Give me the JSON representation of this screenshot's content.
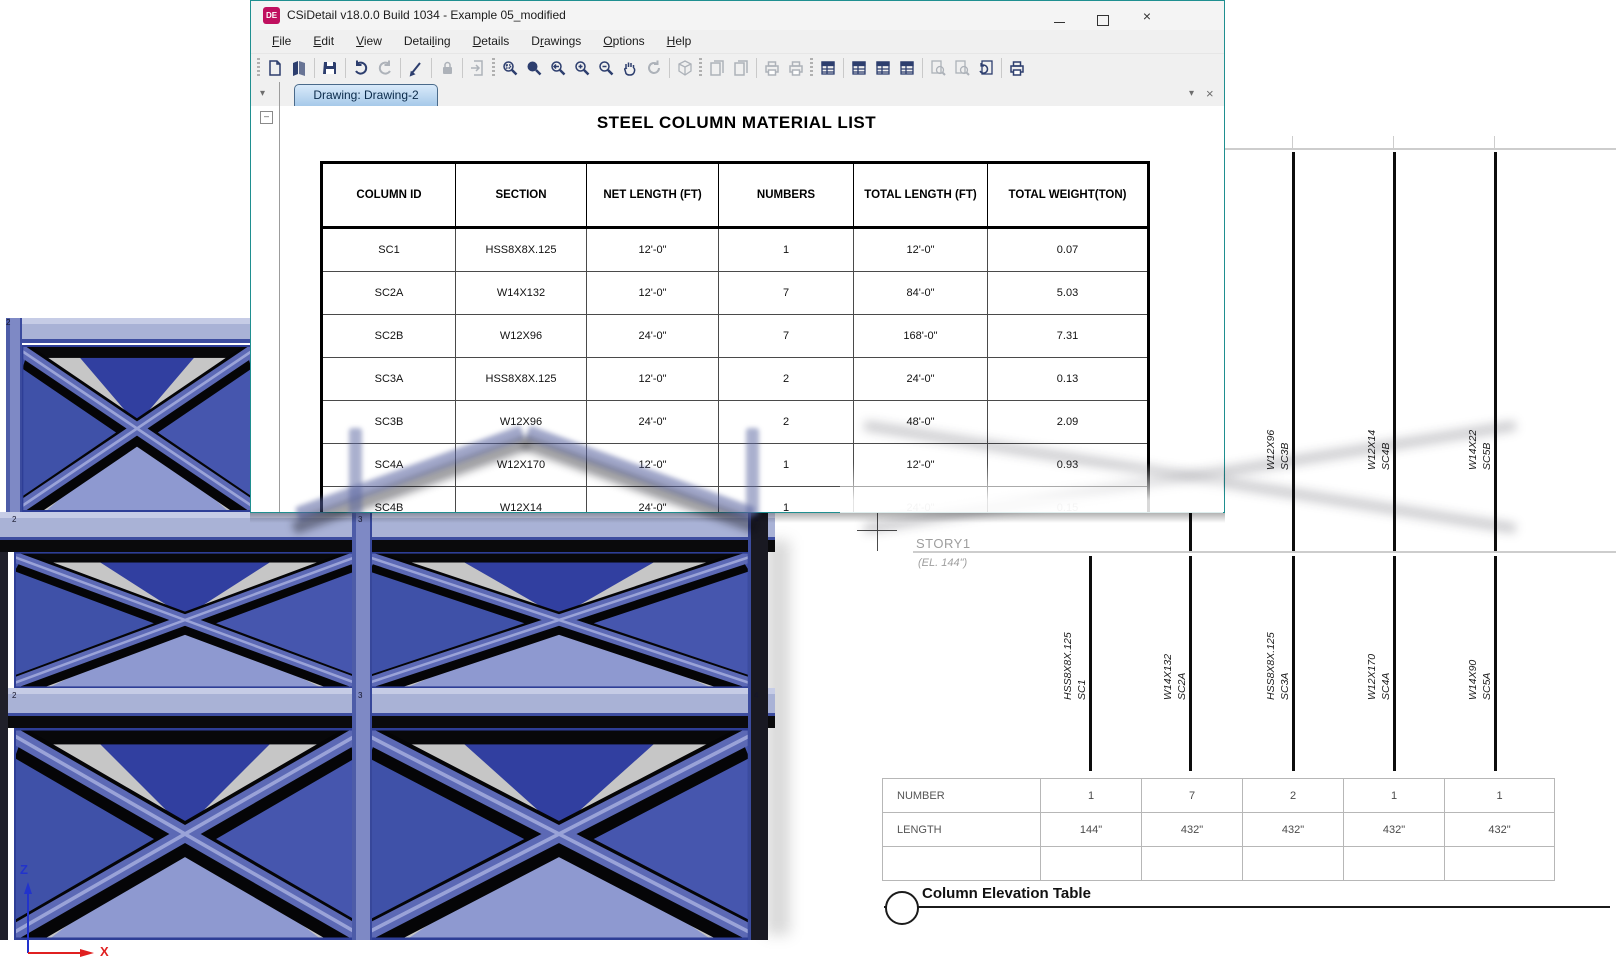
{
  "window": {
    "title": "CSiDetail v18.0.0 Build 1034 - Example 05_modified",
    "app_icon_text": "DE",
    "controls": {
      "close_glyph": "×"
    },
    "menu": {
      "items": [
        {
          "pre": "",
          "key": "F",
          "post": "ile"
        },
        {
          "pre": "",
          "key": "E",
          "post": "dit"
        },
        {
          "pre": "",
          "key": "V",
          "post": "iew"
        },
        {
          "pre": "Detai",
          "key": "l",
          "post": "ing"
        },
        {
          "pre": "",
          "key": "D",
          "post": "etails"
        },
        {
          "pre": "D",
          "key": "r",
          "post": "awings"
        },
        {
          "pre": "",
          "key": "O",
          "post": "ptions"
        },
        {
          "pre": "",
          "key": "H",
          "post": "elp"
        }
      ]
    },
    "toolbar": {
      "buttons": [
        {
          "type": "handle"
        },
        {
          "name": "new-document",
          "enabled": true
        },
        {
          "name": "open",
          "enabled": true
        },
        {
          "type": "sep"
        },
        {
          "name": "save",
          "enabled": true
        },
        {
          "type": "sep"
        },
        {
          "name": "undo",
          "enabled": true
        },
        {
          "name": "redo",
          "enabled": false
        },
        {
          "type": "sep"
        },
        {
          "name": "pen",
          "enabled": true
        },
        {
          "type": "sep"
        },
        {
          "name": "lock",
          "enabled": false
        },
        {
          "type": "sep"
        },
        {
          "name": "export-page",
          "enabled": false
        },
        {
          "type": "handle"
        },
        {
          "name": "zoom-window",
          "enabled": true
        },
        {
          "name": "zoom-in",
          "enabled": true
        },
        {
          "name": "zoom-previous",
          "enabled": true
        },
        {
          "name": "zoom-plus",
          "enabled": true
        },
        {
          "name": "zoom-minus",
          "enabled": true
        },
        {
          "name": "pan",
          "enabled": true
        },
        {
          "name": "rotate-view",
          "enabled": false
        },
        {
          "type": "sep"
        },
        {
          "name": "view-3d",
          "enabled": false
        },
        {
          "type": "handle"
        },
        {
          "name": "doc-previous",
          "enabled": false
        },
        {
          "name": "doc-next",
          "enabled": false
        },
        {
          "type": "sep"
        },
        {
          "name": "print-preview",
          "enabled": false
        },
        {
          "name": "print-export",
          "enabled": false
        },
        {
          "type": "handle"
        },
        {
          "name": "report-list",
          "enabled": true
        },
        {
          "type": "sep"
        },
        {
          "name": "report-options",
          "enabled": true
        },
        {
          "name": "report-table",
          "enabled": true
        },
        {
          "name": "report-window",
          "enabled": true
        },
        {
          "type": "sep"
        },
        {
          "name": "search-add",
          "enabled": false
        },
        {
          "name": "search-view",
          "enabled": false
        },
        {
          "name": "doc-refresh",
          "enabled": true
        },
        {
          "type": "sep"
        },
        {
          "name": "print",
          "enabled": true
        }
      ]
    },
    "tab_strip": {
      "active_tab": "Drawing: Drawing-2",
      "dropdown_glyph": "▾",
      "close_glyph": "×"
    }
  },
  "material_list": {
    "title": "STEEL COLUMN MATERIAL LIST",
    "columns": [
      "COLUMN ID",
      "SECTION",
      "NET LENGTH (FT)",
      "NUMBERS",
      "TOTAL LENGTH (FT)",
      "TOTAL WEIGHT(TON)"
    ],
    "rows": [
      [
        "SC1",
        "HSS8X8X.125",
        "12'-0\"",
        "1",
        "12'-0\"",
        "0.07"
      ],
      [
        "SC2A",
        "W14X132",
        "12'-0\"",
        "7",
        "84'-0\"",
        "5.03"
      ],
      [
        "SC2B",
        "W12X96",
        "24'-0\"",
        "7",
        "168'-0\"",
        "7.31"
      ],
      [
        "SC3A",
        "HSS8X8X.125",
        "12'-0\"",
        "2",
        "24'-0\"",
        "0.13"
      ],
      [
        "SC3B",
        "W12X96",
        "24'-0\"",
        "2",
        "48'-0\"",
        "2.09"
      ],
      [
        "SC4A",
        "W12X170",
        "12'-0\"",
        "1",
        "12'-0\"",
        "0.93"
      ],
      [
        "SC4B",
        "W12X14",
        "24'-0\"",
        "1",
        "24'-0\"",
        "0.15"
      ]
    ]
  },
  "elevation": {
    "story_label": "STORY1",
    "story_elevation": "(EL. 144\")",
    "upper_columns": [
      {
        "section": "W12X96",
        "id": "SC2B"
      },
      {
        "section": "W12X96",
        "id": "SC3B"
      },
      {
        "section": "W12X14",
        "id": "SC4B"
      },
      {
        "section": "W14X22",
        "id": "SC5B"
      }
    ],
    "lower_columns": [
      {
        "section": "HSS8X8X.125",
        "id": "SC1"
      },
      {
        "section": "W14X132",
        "id": "SC2A"
      },
      {
        "section": "HSS8X8X.125",
        "id": "SC3A"
      },
      {
        "section": "W12X170",
        "id": "SC4A"
      },
      {
        "section": "W14X90",
        "id": "SC5A"
      }
    ],
    "summary_table": {
      "rows": [
        {
          "label": "NUMBER",
          "values": [
            "1",
            "7",
            "2",
            "1",
            "1"
          ]
        },
        {
          "label": "LENGTH",
          "values": [
            "144\"",
            "432\"",
            "432\"",
            "432\"",
            "432\""
          ]
        }
      ]
    },
    "drawing_title": "Column Elevation Table"
  },
  "model": {
    "joint_labels": [
      "2",
      "3",
      "4"
    ],
    "axis": {
      "z": "Z",
      "x": "X"
    }
  },
  "colors": {
    "window_border_teal": "#1f8f90",
    "brand_magenta": "#c0105f",
    "tab_blue": "#a6c9e9",
    "member_blue": "#5c69b5",
    "member_light": "#9aa3d8",
    "panel_gray": "#c6c6c6",
    "navy": "#3f51a8",
    "axis_z_blue": "#2233cc",
    "axis_x_red": "#e02020"
  }
}
